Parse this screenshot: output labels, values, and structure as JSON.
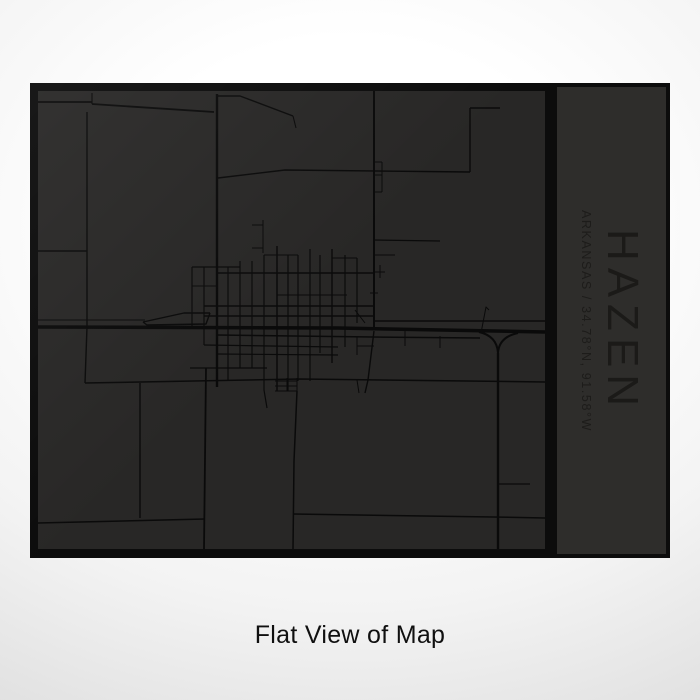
{
  "page": {
    "caption": "Flat View of Map"
  },
  "colors": {
    "page_outer": "#d5d5d5",
    "page_mid": "#f3f3f3",
    "page_center": "#ffffff",
    "frame": "#0c0c0c",
    "map_bg": "#282726",
    "road": "#0a0a0a",
    "panel_bg": "#2e2d2b",
    "title": "#1b1a18",
    "subtitle": "#1d1c1a",
    "caption": "#101010"
  },
  "print": {
    "title": "HAZEN",
    "subtitle": "ARKANSAS / 34.78°N, 91.58°W"
  },
  "map": {
    "viewbox": "0 0 507 458",
    "roads": [
      {
        "d": "M0,236 L300,237 L507,241",
        "w": 3.5
      },
      {
        "d": "M179,3 L179,296",
        "w": 2.4
      },
      {
        "d": "M336,0 L336,238",
        "w": 2
      },
      {
        "d": "M336,240 L330,289 L327,302",
        "w": 1.4
      },
      {
        "d": "M319,289 L321,302",
        "w": 1
      },
      {
        "d": "M460,262 L460,458",
        "w": 2.4
      },
      {
        "d": "M441,241 Q459,245 460,262",
        "w": 2
      },
      {
        "d": "M480,242 Q461,246 460,262",
        "w": 2
      },
      {
        "d": "M0,11 L54,11",
        "w": 1.8
      },
      {
        "d": "M54,2 L54,13",
        "w": 1.2
      },
      {
        "d": "M54,13 L176,21",
        "w": 1.8
      },
      {
        "d": "M179,5 L202,5 L255,25",
        "w": 1.4
      },
      {
        "d": "M255,25 L258,37",
        "w": 1.1
      },
      {
        "d": "M180,87 L247,79 L432,81",
        "w": 1.4
      },
      {
        "d": "M432,17 L432,81",
        "w": 1.4
      },
      {
        "d": "M432,17 L462,17",
        "w": 1.4
      },
      {
        "d": "M336,71 L344,71 M336,84 L344,84 M336,101 L344,101 M344,71 L344,101",
        "w": 1
      },
      {
        "d": "M49,21 L49,236",
        "w": 1.4
      },
      {
        "d": "M49,236 L47,292",
        "w": 1.4
      },
      {
        "d": "M0,160 L49,160",
        "w": 1.4
      },
      {
        "d": "M0,229 L107,229",
        "w": 1
      },
      {
        "d": "M105,231 L146,222 L172,222",
        "w": 1.4
      },
      {
        "d": "M105,231 L109,234 L168,233 L172,222",
        "w": 1.4
      },
      {
        "d": "M47,292 L262,288 L507,291",
        "w": 1.5
      },
      {
        "d": "M152,277 L229,277",
        "w": 1.2
      },
      {
        "d": "M168,277 L166,458",
        "w": 1.8
      },
      {
        "d": "M102,292 L102,427",
        "w": 1.4
      },
      {
        "d": "M0,432 L167,428",
        "w": 1.5
      },
      {
        "d": "M259,300 L256,370 L255,458",
        "w": 1.5
      },
      {
        "d": "M255,423 L455,426 L507,427",
        "w": 1.5
      },
      {
        "d": "M460,393 L492,393",
        "w": 1.2
      },
      {
        "d": "M154,176 L154,236",
        "w": 1.2
      },
      {
        "d": "M166,176 L166,254",
        "w": 1.2
      },
      {
        "d": "M190,176 L190,290",
        "w": 1.2
      },
      {
        "d": "M202,170 L202,277",
        "w": 1.2
      },
      {
        "d": "M214,170 L214,277",
        "w": 1.2
      },
      {
        "d": "M226,164 L226,299 L229,317",
        "w": 1.2
      },
      {
        "d": "M239,155 L239,300",
        "w": 1.5
      },
      {
        "d": "M250,164 L250,300",
        "w": 1.2
      },
      {
        "d": "M260,164 L260,290",
        "w": 1.2
      },
      {
        "d": "M272,158 L272,290",
        "w": 1.2
      },
      {
        "d": "M282,164 L282,262",
        "w": 1.2
      },
      {
        "d": "M294,158 L294,272",
        "w": 1.4
      },
      {
        "d": "M307,164 L307,256",
        "w": 1.2
      },
      {
        "d": "M319,167 L319,232",
        "w": 1.2
      },
      {
        "d": "M319,246 L319,264",
        "w": 1
      },
      {
        "d": "M249,287 L249,300",
        "w": 1
      },
      {
        "d": "M259,287 L259,300",
        "w": 1
      },
      {
        "d": "M237,290 L259,290",
        "w": 1
      },
      {
        "d": "M237,295 L259,295",
        "w": 1
      },
      {
        "d": "M237,300 L259,300",
        "w": 1
      },
      {
        "d": "M226,164 L260,164",
        "w": 1
      },
      {
        "d": "M294,167 L319,167",
        "w": 1
      },
      {
        "d": "M154,176 L202,176",
        "w": 1.2
      },
      {
        "d": "M179,182 L335,182",
        "w": 1.4
      },
      {
        "d": "M154,195 L179,195",
        "w": 1
      },
      {
        "d": "M239,204 L309,204",
        "w": 1
      },
      {
        "d": "M166,215 L335,215",
        "w": 1.4
      },
      {
        "d": "M166,225 L335,225",
        "w": 1.4
      },
      {
        "d": "M335,230 L507,230",
        "w": 1.4
      },
      {
        "d": "M179,244 L335,246 L442,247",
        "w": 1.5
      },
      {
        "d": "M166,254 L300,256",
        "w": 1.2
      },
      {
        "d": "M179,263 L300,264",
        "w": 1.2
      },
      {
        "d": "M319,255 L336,255",
        "w": 1
      },
      {
        "d": "M336,164 L357,164",
        "w": 1
      },
      {
        "d": "M342,174 L342,187",
        "w": 1
      },
      {
        "d": "M337,181 L347,181",
        "w": 1
      },
      {
        "d": "M332,202 L340,202",
        "w": 1
      },
      {
        "d": "M317,219 L327,232",
        "w": 1
      },
      {
        "d": "M443,242 L448,216 L451,219",
        "w": 1
      },
      {
        "d": "M225,129 L225,162",
        "w": 1
      },
      {
        "d": "M214,134 L225,134",
        "w": 1
      },
      {
        "d": "M214,157 L225,157",
        "w": 1
      },
      {
        "d": "M367,239 L367,255",
        "w": 1
      },
      {
        "d": "M402,245 L402,257",
        "w": 1
      },
      {
        "d": "M335,149 L402,150",
        "w": 1.2
      }
    ]
  }
}
